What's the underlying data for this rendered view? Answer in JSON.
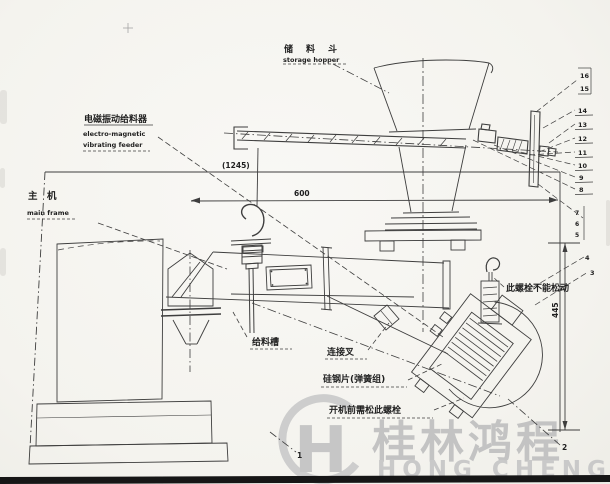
{
  "labels": {
    "storage_hopper_cn": "储　料　斗",
    "storage_hopper_en": "storage hopper",
    "feeder_cn": "电磁振动给料器",
    "feeder_en1": "electro-magnetic",
    "feeder_en2": "vibrating feeder",
    "main_frame_cn": "主　机",
    "main_frame_en": "main frame",
    "feed_trough_cn": "给料槽",
    "connecting_fork_cn": "连接叉",
    "spring_pack_cn": "硅钢片(弹簧组)",
    "loosen_before_start_cn": "开机前需松此螺栓",
    "do_not_loosen_cn": "此螺栓不能松动"
  },
  "dimensions": {
    "overall_width": "(1245)",
    "trough_length": "600",
    "height": "445"
  },
  "callouts": {
    "right": [
      "16",
      "15",
      "14",
      "13",
      "12",
      "11",
      "10",
      "9",
      "8"
    ],
    "mid_group": [
      "7",
      "6",
      "5"
    ],
    "lower": [
      "4",
      "3"
    ],
    "bottom_left": "1",
    "bottom_right": "2"
  },
  "watermark": {
    "logo_letter": "H",
    "brand_cn": "桂林鸿程",
    "brand_en": "HONG CHENG",
    "color": "#c6c6c6"
  },
  "ink_color": "#2b2b2b"
}
